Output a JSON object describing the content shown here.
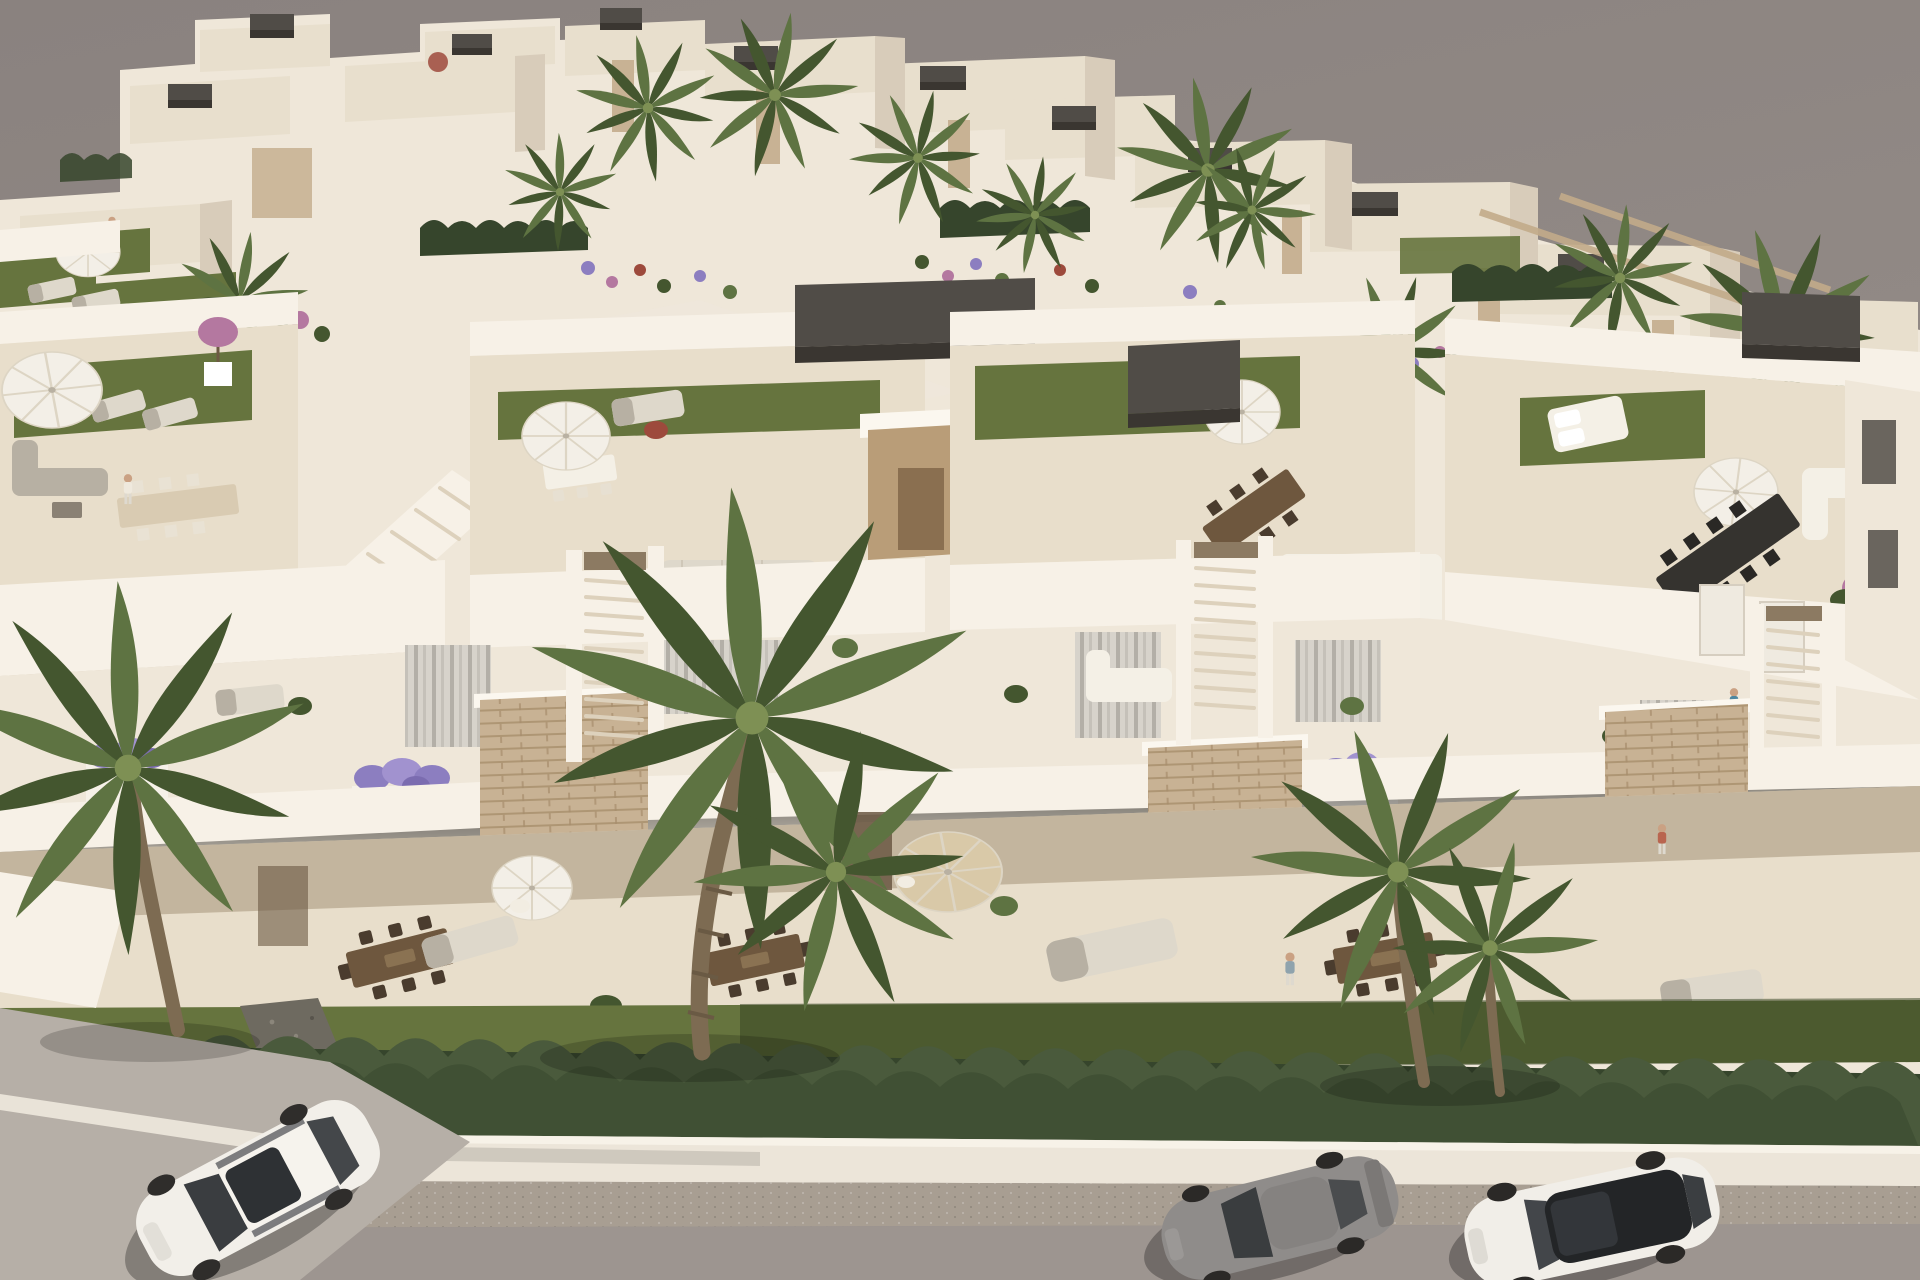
{
  "meta": {
    "kind": "architectural-visualization",
    "description": "Aerial 3D render of a modern white townhouse development at golden hour, street with parked cars in the foreground",
    "camera": "high oblique aerial",
    "lighting": "warm low sun from the right"
  },
  "palette": {
    "sky_top": "#8a827f",
    "sky_main": "#98908b",
    "wall_sun": "#f7f1e7",
    "wall_light": "#efe7d9",
    "wall_shadow": "#dbcfbd",
    "wall_deep": "#c8b9a4",
    "roof_floor": "#e8decb",
    "patio_shadow": "#b4a58c",
    "grass": "#66743e",
    "grass_dark": "#31401f",
    "hedge": "#4a5a3c",
    "hedge_dark": "#36452c",
    "palm": "#5e7342",
    "palm_dark": "#44562f",
    "palm_light": "#7e9054",
    "trunk": "#7d6b52",
    "pergola": "#504c47",
    "pergola_dark": "#3a3631",
    "stone": "#c8b294",
    "stone_line": "#a78e6c",
    "wood": "#6e573e",
    "wood_dark": "#4a3c2e",
    "sidewalk": "#ece5d9",
    "road": "#9d9590",
    "road_edge": "#a89e92",
    "apron": "#b6afa7",
    "gravel": "#6e6a60",
    "umbrella": "#f3efe7",
    "umbrella_line": "#ddd5c4",
    "tan_umbrella": "#d9c9a8",
    "furn_white": "#f4f0e6",
    "furn_gray": "#b7b0a3",
    "furn_light": "#ded8cb",
    "table_dark": "#35332f",
    "car_white": "#f2efe9",
    "car_gray": "#8f8c8a",
    "glass": "#3a3d40",
    "glass_deep": "#242628",
    "flower_purple": "#8c7ec0",
    "flower_pink": "#b478a0",
    "flower_red": "#9d4a3c",
    "pool": "#b9c4c8",
    "skin": "#caa183"
  },
  "scene": {
    "sky": "uniform warm grey haze",
    "background": {
      "villas": "two receding rows of white cubic villas with flat roofs, dark rooftop pergola cubes and sand-stone clad pillars",
      "palms": "scattered fan palms along the skyline",
      "gardens": "flowering borders in purple, pink and red",
      "pool_hint": "small pale-blue pool between villas"
    },
    "main_row": {
      "units": 4,
      "features": [
        "roof terraces with artificial lawn strips",
        "white parasols and outdoor lounge/dining furniture",
        "dark grey pergola volumes",
        "timber stair bulkheads",
        "external staircases between units",
        "stacked-stone clad facade panels",
        "balconies with lavender planter boxes and curtained glazing",
        "shaded ground-floor patios with timber dining tables and day beds"
      ]
    },
    "street": {
      "lawn": "olive green lawn strip",
      "hedge": "continuous clipped cypress hedge along the plot line",
      "sidewalk": "white kerb and pavement band",
      "road": "two-tone grey asphalt"
    },
    "vehicles": [
      {
        "name": "white-suv",
        "position": "bottom left",
        "color": "white"
      },
      {
        "name": "grey-sports-coupe",
        "position": "bottom centre-right",
        "color": "grey"
      },
      {
        "name": "white-sedan-black-roof",
        "position": "bottom right",
        "color": "white with black glass roof"
      }
    ],
    "people": 7,
    "foreground_palms": 4
  }
}
